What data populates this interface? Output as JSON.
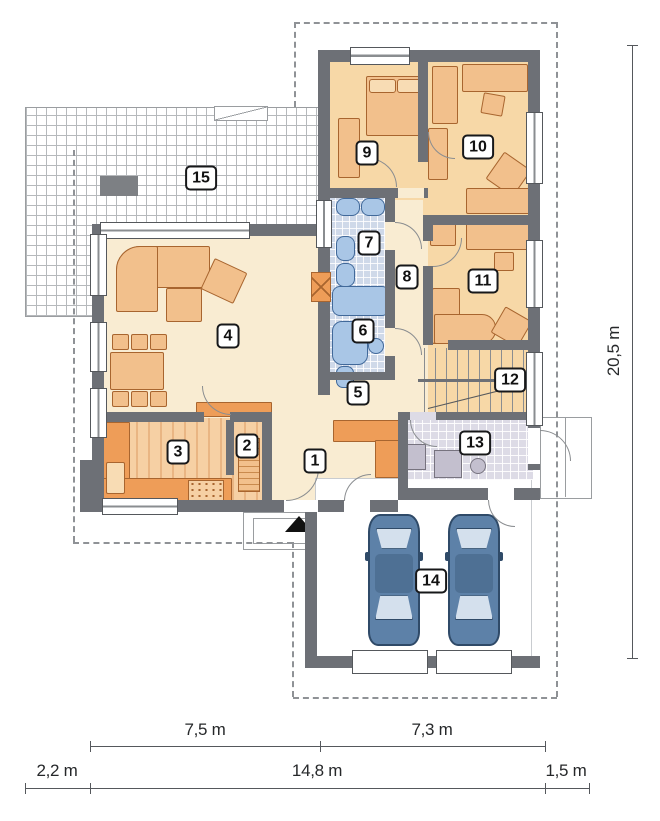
{
  "plan": {
    "type": "floor-plan",
    "rooms": [
      {
        "id": 1,
        "label": "1"
      },
      {
        "id": 2,
        "label": "2"
      },
      {
        "id": 3,
        "label": "3"
      },
      {
        "id": 4,
        "label": "4"
      },
      {
        "id": 5,
        "label": "5"
      },
      {
        "id": 6,
        "label": "6"
      },
      {
        "id": 7,
        "label": "7"
      },
      {
        "id": 8,
        "label": "8"
      },
      {
        "id": 9,
        "label": "9"
      },
      {
        "id": 10,
        "label": "10"
      },
      {
        "id": 11,
        "label": "11"
      },
      {
        "id": 12,
        "label": "12"
      },
      {
        "id": 13,
        "label": "13"
      },
      {
        "id": 14,
        "label": "14"
      },
      {
        "id": 15,
        "label": "15"
      }
    ],
    "dims": {
      "row1": [
        {
          "label": "7,5 m"
        },
        {
          "label": "7,3 m"
        }
      ],
      "row2": [
        {
          "label": "2,2 m"
        },
        {
          "label": "14,8 m"
        },
        {
          "label": "1,5 m"
        }
      ],
      "right": {
        "label": "20,5 m"
      }
    },
    "colors": {
      "wall": "#6d7076",
      "floor_main": "#f9ecd2",
      "floor_bedroom": "#f7d8a7",
      "bath_tile": "#cfd9e9",
      "utility_tile": "#dddbe6",
      "furniture": "#f2c08c",
      "furniture_accent": "#ee9d58",
      "fixture_blue": "#a9c6e6",
      "car_blue": "#5d81a8"
    }
  }
}
